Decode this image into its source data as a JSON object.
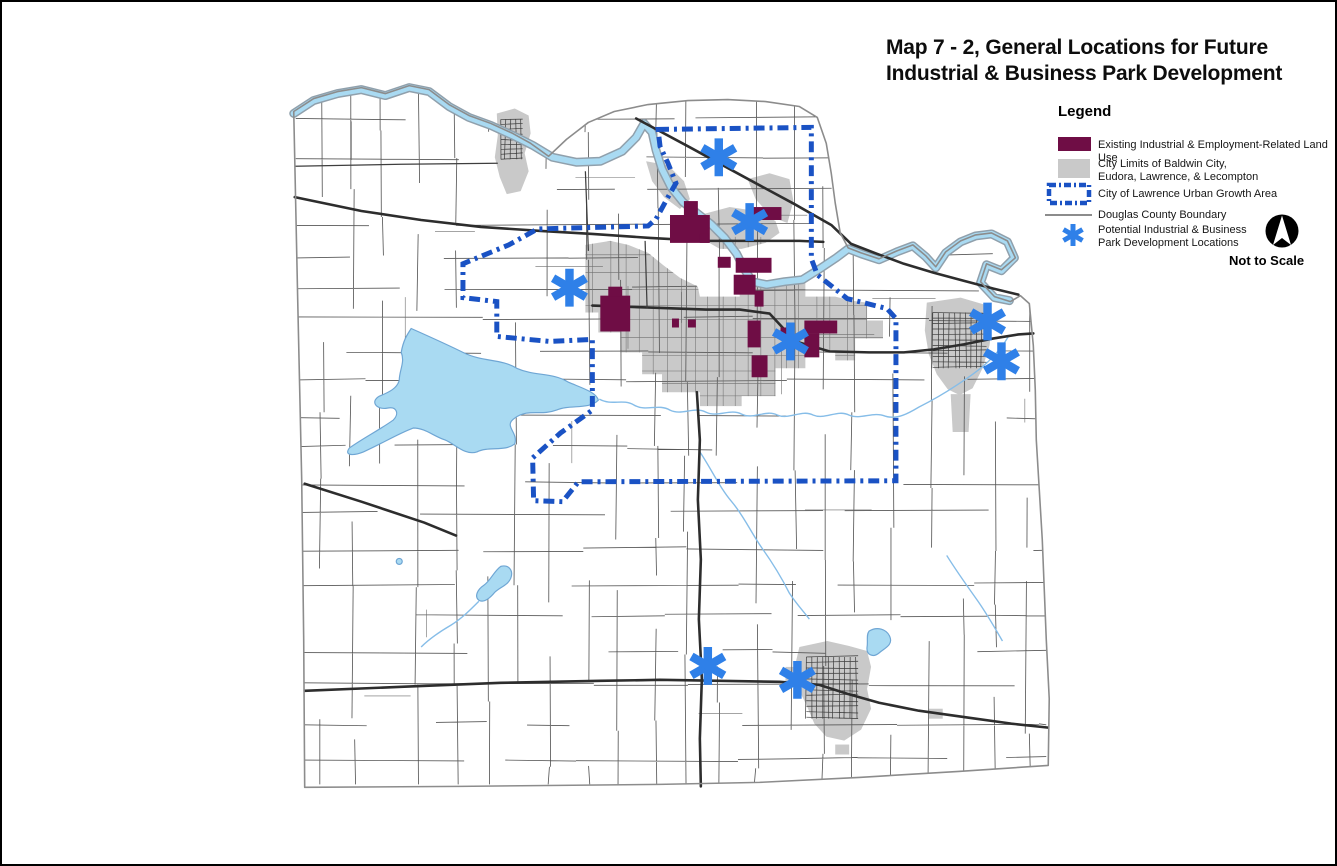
{
  "title": {
    "line1": "Map 7 - 2, General Locations for Future",
    "line2": "Industrial & Business Park Development"
  },
  "legend": {
    "heading": "Legend",
    "items": [
      {
        "id": "existing-industrial",
        "label": "Existing Industrial & Employment-Related Land Use"
      },
      {
        "id": "city-limits",
        "label": "City Limits of Baldwin City,\nEudora, Lawrence, & Lecompton"
      },
      {
        "id": "urban-growth-area",
        "label": "City of Lawrence Urban Growth Area"
      },
      {
        "id": "county-boundary",
        "label": "Douglas County Boundary"
      },
      {
        "id": "potential-locations",
        "label": "Potential Industrial & Business\nPark Development Locations"
      }
    ]
  },
  "scale_note": "Not to Scale",
  "north_arrow_icon": "north-arrow-icon",
  "colors": {
    "industrial": "#6F0D45",
    "city_limits": "#C9C9C9",
    "growth_area": "#1A52C4",
    "county_boundary": "#8C8C8C",
    "marker": "#2F80E8",
    "water_fill": "#A9DAF2",
    "water_edge": "#6FA6D4",
    "road_major": "#2D2D2D",
    "road_minor": "#585858"
  },
  "map": {
    "marker_count": 8,
    "markers": [
      {
        "x": 719,
        "y": 156
      },
      {
        "x": 750,
        "y": 221
      },
      {
        "x": 569,
        "y": 287
      },
      {
        "x": 791,
        "y": 341
      },
      {
        "x": 989,
        "y": 321
      },
      {
        "x": 1003,
        "y": 361
      },
      {
        "x": 708,
        "y": 667
      },
      {
        "x": 798,
        "y": 681
      }
    ]
  }
}
